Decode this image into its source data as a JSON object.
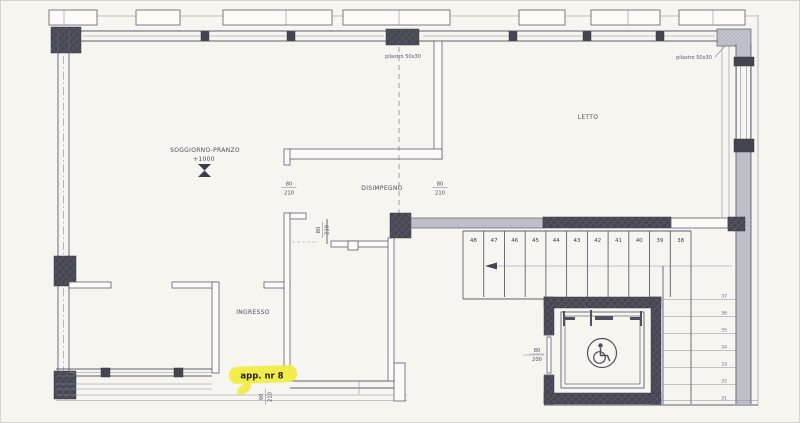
{
  "plan": {
    "rooms": {
      "soggiorno": "SOGGIORNO-PRANZO",
      "disimpegno": "DISIMPEGNO",
      "letto": "LETTO",
      "ingresso": "INGRESSO"
    },
    "level_mark": "+1000",
    "apartment_label": "app. nr 8",
    "pillar_top_label": "pilastro 50x30",
    "pillar_right_label": "pilastro 50x30",
    "dims": {
      "door_soggiorno": {
        "num": "80",
        "den": "210"
      },
      "door_letto": {
        "num": "80",
        "den": "210"
      },
      "door_hall": {
        "num": "80",
        "den": "210"
      },
      "door_entrance": {
        "num": "90",
        "den": "210"
      },
      "door_elevator": {
        "num": "80",
        "den": "200"
      }
    },
    "stairs": {
      "main_flight": [
        "48",
        "47",
        "46",
        "45",
        "44",
        "43",
        "42",
        "41",
        "40",
        "39",
        "38"
      ],
      "return_flight": [
        "37",
        "36",
        "35",
        "34",
        "33",
        "32",
        "31"
      ]
    },
    "icons": {
      "wheelchair": "wheelchair-accessible-elevator",
      "level_marker": "level-benchmark"
    },
    "colors": {
      "paper": "#f7f5f0",
      "line": "#5e5e72",
      "wall_dark": "#45454f",
      "wall_gray": "#c3c3cd",
      "highlight": "#f1ea3e"
    }
  }
}
